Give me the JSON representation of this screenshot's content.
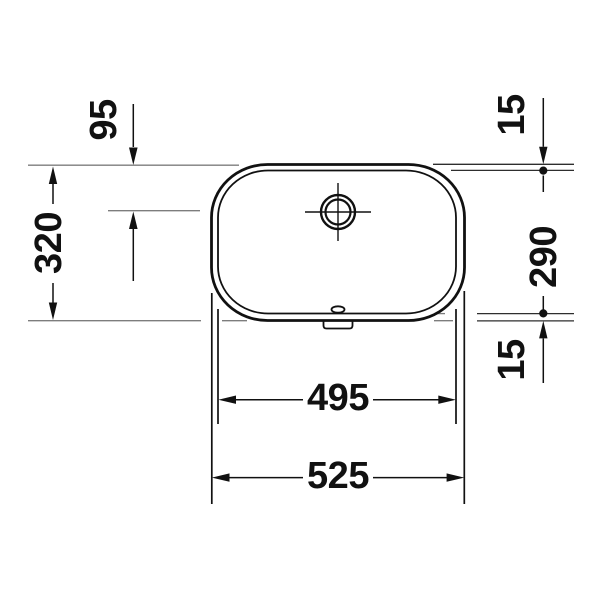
{
  "drawing": {
    "title": "washbasin-top-view-dimension-drawing",
    "colors": {
      "background": "#ffffff",
      "line": "#111111",
      "reference_line": "#7d7d7d",
      "secondary_reference_line": "#2e2e2e"
    },
    "dimensions": {
      "faucet_offset_top": "95",
      "rim_top": "15",
      "overall_depth": "320",
      "basin_depth": "290",
      "rim_bottom": "15",
      "basin_width": "495",
      "overall_width": "525"
    }
  }
}
